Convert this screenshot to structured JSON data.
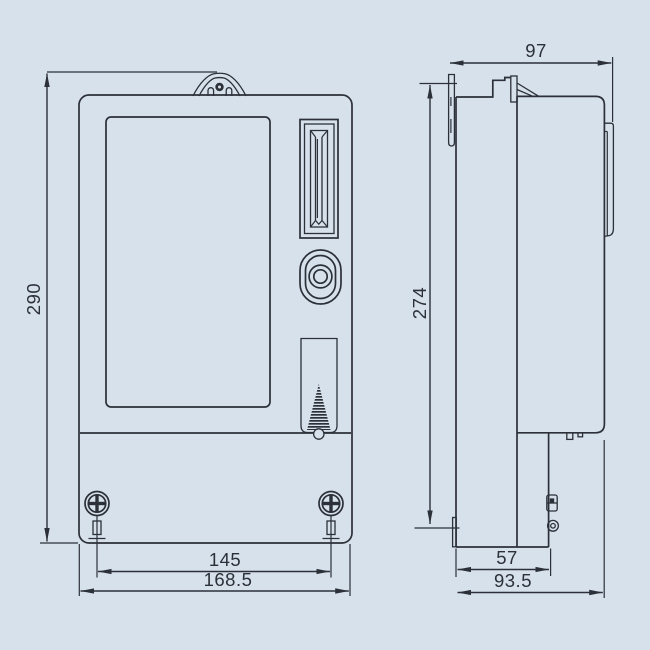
{
  "drawing": {
    "kind": "technical-dimension-drawing",
    "views": [
      "front-view",
      "side-view"
    ]
  },
  "dims": {
    "front_height": "290",
    "front_hole_spacing": "145",
    "front_overall_width": "168.5",
    "side_top_depth": "97",
    "side_mounting_height": "274",
    "side_terminal_depth": "57",
    "side_overall_depth": "93.5"
  },
  "colors": {
    "background": "#d7e1ec",
    "line": "#2c3038"
  }
}
